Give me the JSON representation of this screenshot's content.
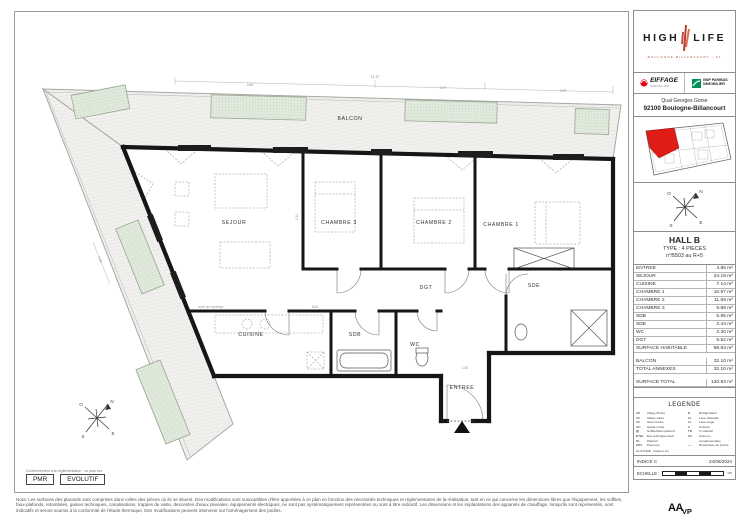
{
  "header": {
    "logo": {
      "word1": "HIGH",
      "word2": "LIFE",
      "subtitle": "BOULOGNE-BILLANCOURT • 92"
    },
    "developers": {
      "eiffage": "EIFFAGE",
      "eiffage_sub": "IMMOBILIER",
      "bnp_line1": "BNP PARIBAS",
      "bnp_line2": "IMMOBILIER"
    },
    "address": {
      "line1": "Quai Georges Gorse",
      "line2": "92100 Boulogne-Billancourt"
    }
  },
  "unit": {
    "hall": "HALL B",
    "type": "TYPE : 4 PIECES",
    "number": "n°B503 au R+5"
  },
  "areas": {
    "rows": [
      {
        "label": "ENTREE",
        "value": "4.86 m²"
      },
      {
        "label": "SEJOUR",
        "value": "24.18 m²"
      },
      {
        "label": "CUISINE",
        "value": "7.14 m²"
      },
      {
        "label": "CHAMBRE 1",
        "value": "10.97 m²"
      },
      {
        "label": "CHAMBRE 2",
        "value": "11.59 m²"
      },
      {
        "label": "CHAMBRE 3",
        "value": "9.88 m²"
      },
      {
        "label": "SDB",
        "value": "5.95 m²"
      },
      {
        "label": "SDE",
        "value": "2.44 m²"
      },
      {
        "label": "WC",
        "value": "2.30 m²"
      },
      {
        "label": "DGT",
        "value": "9.52 m²"
      }
    ],
    "habitable": {
      "label": "SURFACE HABITABLE",
      "value": "88.83 m²"
    },
    "annexes": [
      {
        "label": "BALCON",
        "value": "32.10 m²"
      },
      {
        "label": "TOTAL ANNEXES",
        "value": "32.10 m²"
      }
    ],
    "total": {
      "label": "SURFACE TOTAL",
      "value": "120.93 m²"
    }
  },
  "legend": {
    "title": "LEGENDE",
    "items_left": [
      {
        "abbr": "AP",
        "label": "Allège Pleine"
      },
      {
        "abbr": "AV",
        "label": "Allège vitrée"
      },
      {
        "abbr": "CF",
        "label": "Store banne"
      },
      {
        "abbr": "GC",
        "label": "Garde-corps"
      },
      {
        "abbr": "▨",
        "label": "Soffite/Faux-plafond"
      },
      {
        "abbr": "ETEL",
        "label": "Esp technique élect."
      },
      {
        "abbr": "PL",
        "label": "Placard"
      },
      {
        "abbr": "PRV",
        "label": "Pare-vue"
      }
    ],
    "items_right": [
      {
        "abbr": "R",
        "label": "Réfrigérateur"
      },
      {
        "abbr": "LV",
        "label": "Lave-Vaisselle"
      },
      {
        "abbr": "LL",
        "label": "Lave-Linge"
      },
      {
        "abbr": "C",
        "label": "Cuisson"
      },
      {
        "abbr": "TR",
        "label": "Tri sélectif"
      },
      {
        "abbr": "AC",
        "label": "Antenne complémentaire"
      },
      {
        "abbr": "----",
        "label": "Retombées de poutre"
      }
    ],
    "footer_line": "CLOTURE : hauteur 1m",
    "indice": "INDICE C",
    "date": "24/06/2024",
    "scale_label": "ECHELLE :",
    "scale_unit": "cm"
  },
  "plan": {
    "rooms": {
      "balcon": "BALCON",
      "sejour": "SEJOUR",
      "chambre3": "CHAMBRE 3",
      "chambre2": "CHAMBRE 2",
      "chambre1": "CHAMBRE 1",
      "dgt": "DGT",
      "sde": "SDE",
      "cuisine": "CUISINE",
      "sdb": "SDB",
      "wc": "WC",
      "entree": "ENTREE"
    },
    "dimensions": [
      "11.37",
      "3.60",
      "2.47",
      "2.67",
      "3.51",
      "6.61",
      "1.90",
      "3.11"
    ],
    "annotation_carrelage": "arrêt de carrelage",
    "compass": {
      "n": "N",
      "s": "S",
      "e": "E",
      "o": "O"
    }
  },
  "compliance": {
    "note": "Conformément à la réglementation , ce plan est",
    "pmr": "PMR",
    "evolutif": "EVOLUTIF"
  },
  "footer": {
    "nota": "Nota: Les surfaces des placards sont comprises dans celles des pièces où ils se situent. Des modifications sont susceptibles d'être apportées à ce plan en fonction des nécessités techniques et réglementaires de la réalisation, tant en ce qui concerne les dimensions libres que l'équipement, les soffites, faux-plafonds, retombées, gaines techniques, canalisations, trappes de visite, descentes d'eaux pluviales, équipements électriques, ne sont pas systématiquement représentées ou sont à titre indicatif. Les dimensions et les implantations des appareils de chauffage, lorsqu'ils sont représentés, sont indicatifs et seront soumis à la conformité de l'étude thermique. Des modifications peuvent intervenir sur l'aménagement des jardins.",
    "architect_main": "AA",
    "architect_sub": "VP"
  }
}
